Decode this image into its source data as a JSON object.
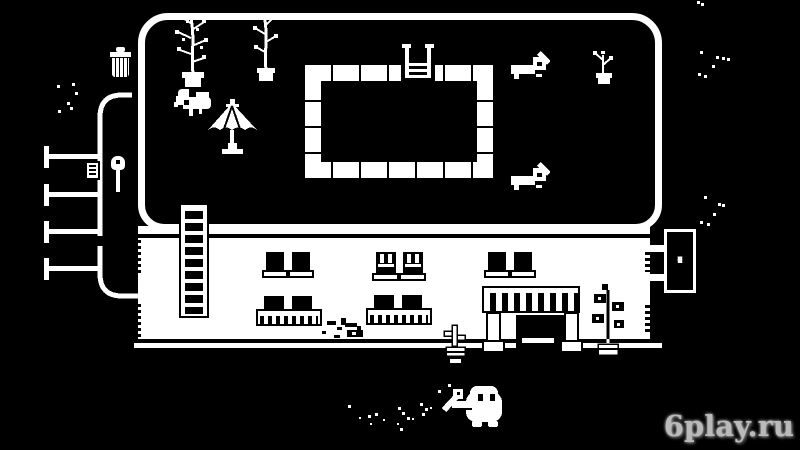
{
  "colors": {
    "background": "#000000",
    "ink": "#ffffff",
    "watermark_text": "#d4d4d4"
  },
  "hotel_sign": {
    "text": "HOTEL",
    "letters": [
      "H",
      "O",
      "T",
      "E",
      "L"
    ]
  },
  "watermark": {
    "text": "6play.ru"
  },
  "decor": {
    "noise_specks": [
      [
        57,
        85
      ],
      [
        72,
        83
      ],
      [
        75,
        92
      ],
      [
        67,
        102
      ],
      [
        58,
        110
      ],
      [
        70,
        107
      ],
      [
        700,
        51
      ],
      [
        716,
        56
      ],
      [
        722,
        57
      ],
      [
        712,
        65
      ],
      [
        698,
        73
      ],
      [
        704,
        75
      ],
      [
        727,
        58
      ],
      [
        704,
        196
      ],
      [
        718,
        203
      ],
      [
        722,
        204
      ],
      [
        713,
        213
      ],
      [
        700,
        221
      ],
      [
        707,
        223
      ],
      [
        697,
        1
      ],
      [
        701,
        3
      ]
    ],
    "dust_specks": [
      [
        348,
        405,
        3
      ],
      [
        368,
        415,
        3
      ],
      [
        370,
        423,
        2
      ],
      [
        375,
        413,
        3
      ],
      [
        383,
        419,
        2
      ],
      [
        398,
        407,
        3
      ],
      [
        402,
        412,
        3
      ],
      [
        407,
        417,
        3
      ],
      [
        397,
        423,
        2
      ],
      [
        400,
        428,
        3
      ],
      [
        412,
        418,
        2
      ],
      [
        420,
        403,
        3
      ],
      [
        425,
        408,
        3
      ],
      [
        430,
        407,
        2
      ],
      [
        422,
        413,
        3
      ],
      [
        359,
        417,
        2
      ]
    ]
  }
}
